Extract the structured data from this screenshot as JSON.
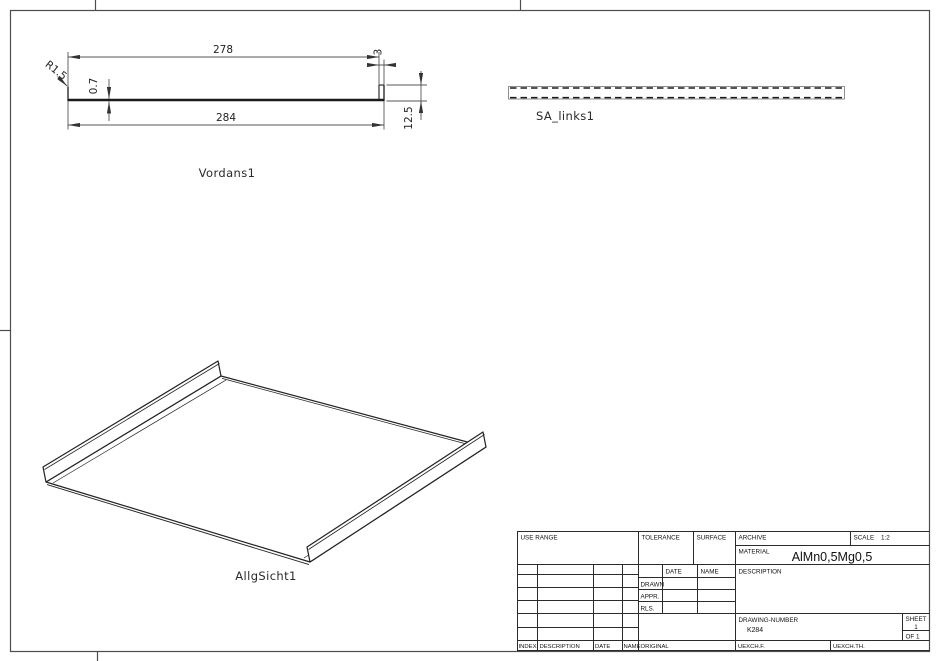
{
  "views": {
    "front": {
      "label": "Vordans1",
      "dim_inner_width": "278",
      "dim_outer_width": "284",
      "dim_thickness": "0.7",
      "dim_flange_offset": "3",
      "dim_flange_height": "12.5",
      "dim_radius": "R1.5"
    },
    "side": {
      "label": "SA_links1"
    },
    "iso": {
      "label": "AllgSicht1"
    }
  },
  "title_block": {
    "use_range": "USE RANGE",
    "tolerance": "TOLERANCE",
    "surface": "SURFACE",
    "archive": "ARCHIVE",
    "scale_label": "SCALE",
    "scale_value": "1:2",
    "material_label": "MATERIAL",
    "material_value": "AlMn0,5Mg0,5",
    "date": "DATE",
    "name": "NAME",
    "drawn": "DRAWN",
    "appr": "APPR.",
    "rls": "RLS.",
    "description": "DESCRIPTION",
    "drawing_number_label": "DRAWING-NUMBER",
    "drawing_number_value": "K284",
    "sheet_label": "SHEET",
    "sheet_value": "1",
    "of_value": "OF 1",
    "index": "INDEX",
    "rev_description": "DESCRIPTION",
    "rev_date": "DATE",
    "rev_name": "NAME",
    "original": "ORIGINAL",
    "uexchf": "UEXCH.F.",
    "uexchth": "UEXCH.TH."
  },
  "colors": {
    "line": "#1b1b1b",
    "dimension": "#555555",
    "paper": "#ffffff"
  }
}
